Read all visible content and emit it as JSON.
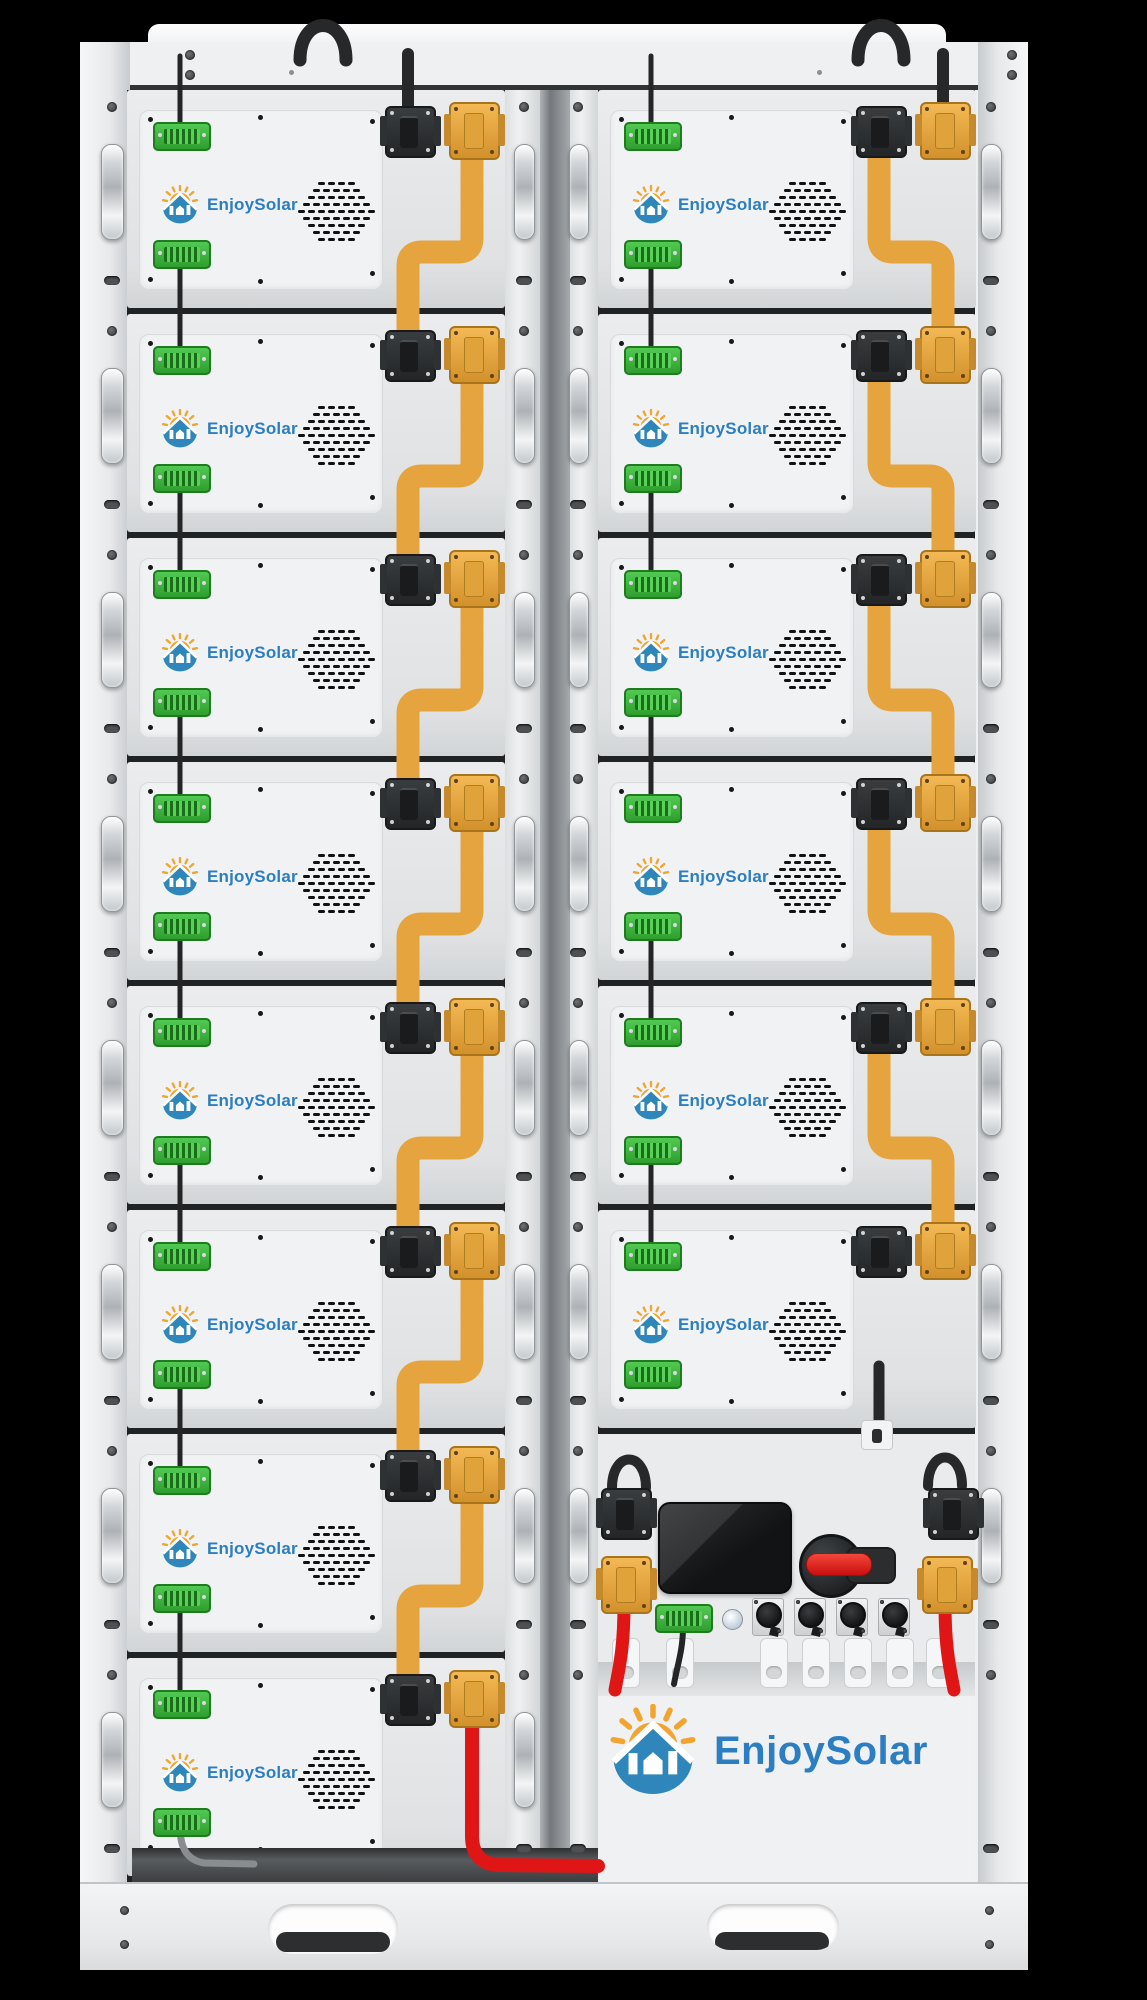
{
  "meta": {
    "description": "Product render of a two-column rack-mounted battery energy storage cabinet",
    "visible_text_instances": 15
  },
  "brand": {
    "name": "EnjoySolar"
  },
  "rack": {
    "left_column": {
      "module_count": 8
    },
    "right_column": {
      "module_count": 6,
      "has_control_unit": true,
      "has_brand_panel": true
    },
    "module": {
      "logo_text": "EnjoySolar",
      "ports": [
        "comm-connector-top",
        "comm-connector-bottom",
        "dc-connector-black",
        "dc-connector-orange"
      ],
      "vent_rows": [
        4,
        5,
        6,
        7,
        8,
        7,
        6,
        5,
        4
      ]
    },
    "control_unit": {
      "display_screen": "blank",
      "breaker": "rotary-disconnect-red-handle",
      "round_socket_count": 4,
      "indicator_button_count": 1,
      "comm_terminal_count": 1,
      "cable_clip_count": 7
    },
    "base_slot_count": 2
  },
  "colors": {
    "background": "#000000",
    "cabinet": "#eef0f1",
    "module_face": "#e7e9eb",
    "divider": "#84888c",
    "comm_connector_green": "#3cb23c",
    "dc_connector_black": "#2e3032",
    "dc_connector_orange": "#e2a23c",
    "busbar_orange": "#e5a43d",
    "cable_black": "#26282a",
    "cable_red": "#e01616",
    "cable_gray": "#8a8d90",
    "logo_blue": "#2b7ec2",
    "logo_orange": "#f2a431",
    "house_blue": "#2e86ba",
    "breaker_red": "#e31c1c"
  }
}
